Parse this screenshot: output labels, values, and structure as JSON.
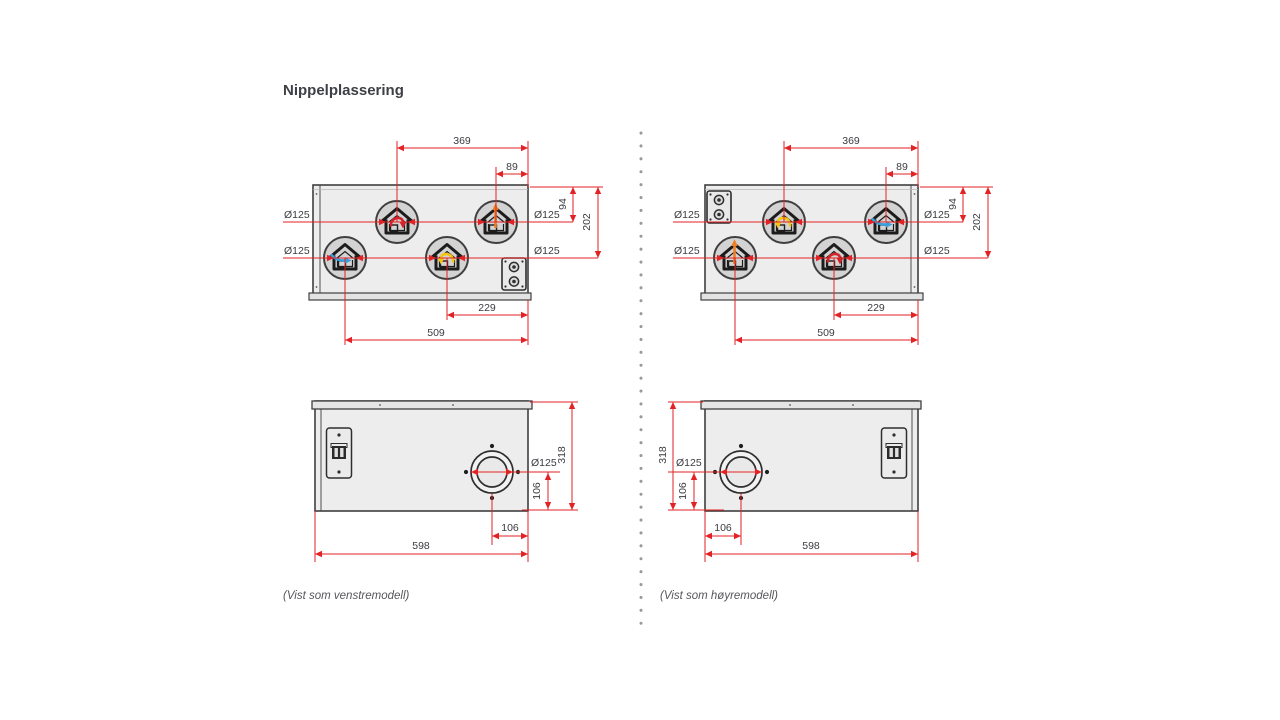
{
  "title": "Nippelplassering",
  "captions": {
    "left_model": "(Vist som venstremodell)",
    "right_model": "(Vist som høyremodell)"
  },
  "dims_top": {
    "w369": "369",
    "w89": "89",
    "d94": "94",
    "d202": "202",
    "dia": "Ø125",
    "w229": "229",
    "w509": "509"
  },
  "dims_front": {
    "h318": "318",
    "dia": "Ø125",
    "o106": "106",
    "w598": "598"
  },
  "icons": {
    "house_extract": "house-with-red-return-arrow",
    "house_exhaust": "house-with-orange-up-arrow",
    "house_outdoor": "house-with-blue-inlet-arrow",
    "house_supply": "house-with-yellow-return-arrow",
    "connector": "electrical-gland-plate",
    "latch": "door-latch",
    "front_port": "round-duct-port"
  },
  "colors": {
    "dimension_red": "#e32225",
    "arrow_red": "#d2232a",
    "arrow_orange": "#ee7f22",
    "arrow_yellow": "#f5c50f",
    "arrow_blue": "#3aa0dc",
    "body_fill": "#ededed",
    "circle_fill": "#d3d3d3",
    "outline": "#3f3f3f",
    "divider_dot": "#9a9a9a"
  }
}
